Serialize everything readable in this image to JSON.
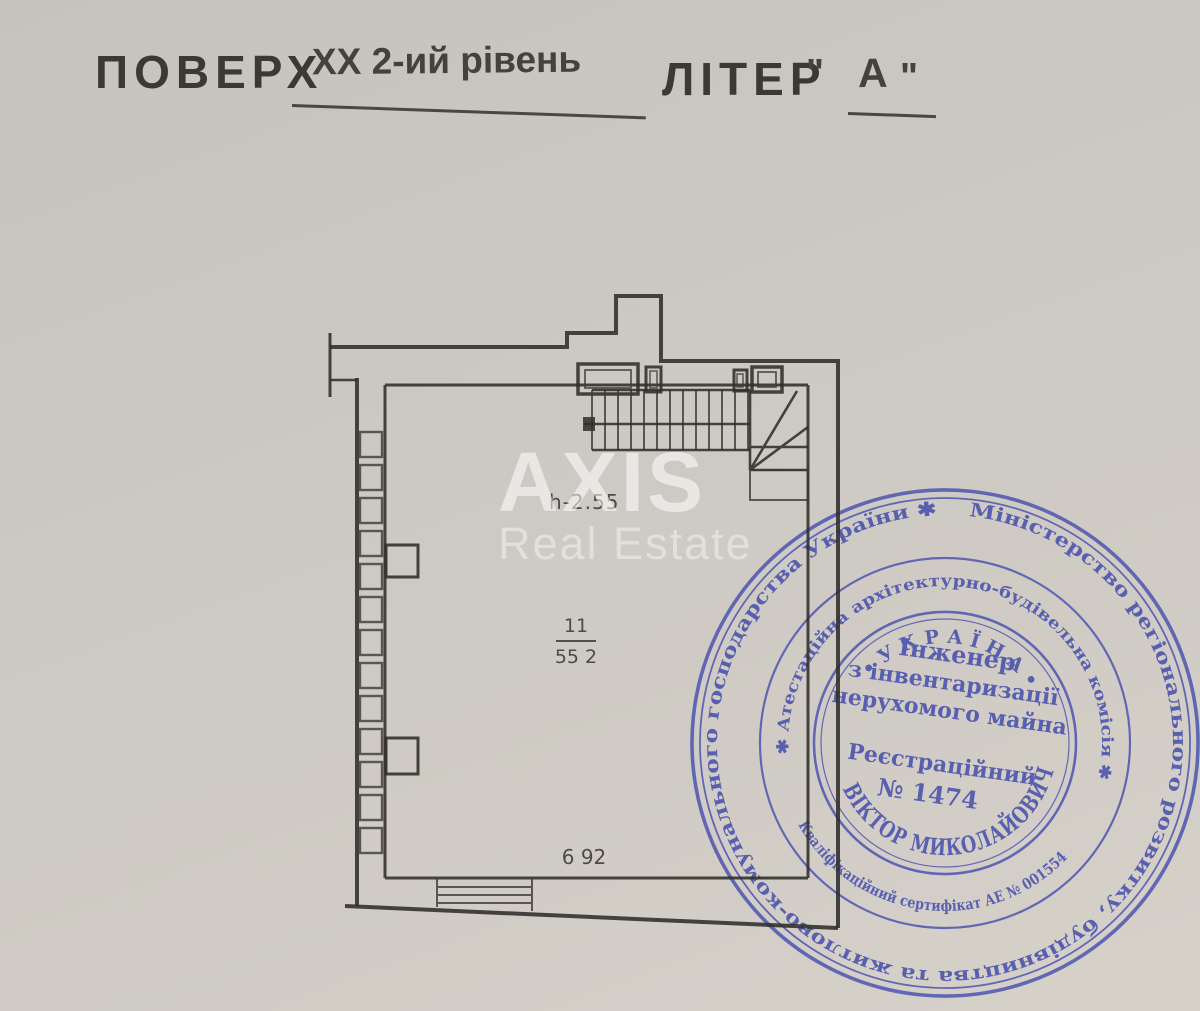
{
  "header": {
    "floor_label": "ПОВЕРХ",
    "floor_value": "XX 2-ий рівень",
    "liter_label": "ЛІТЕР",
    "quote_open": "\"",
    "liter_value": "А",
    "quote_close": "\""
  },
  "watermark": {
    "line1": "AXIS",
    "line2": "Real Estate"
  },
  "plan": {
    "height_note": "h-2.55",
    "room_number": "11",
    "room_area": "55 2",
    "bottom_dimension": "6 92"
  },
  "stamp": {
    "outer_ring": "Міністерство регіонального розвитку, будівництва та житлово-комунального господарства України ✱",
    "middle_ring_top": "✱ Атестаційна архітектурно-будівельна комісія ✱",
    "middle_ring_bottom": "Кваліфікаційний сертифікат АЕ № 001554",
    "country_arc": "• У К Р А Ї Н А •",
    "title_line1": "Інженер",
    "title_line2": "з інвентаризації",
    "title_line3": "нерухомого майна",
    "registry_label": "Реєстраційний",
    "registry_number": "№ 1474",
    "name_arc": "ВІКТОР МИКОЛАЙОВИЧ"
  },
  "colors": {
    "paper": "#cbc8c2",
    "ink": "#2f2e2a",
    "stamp_blue": "#3f48ab",
    "watermark": "#ffffff"
  }
}
